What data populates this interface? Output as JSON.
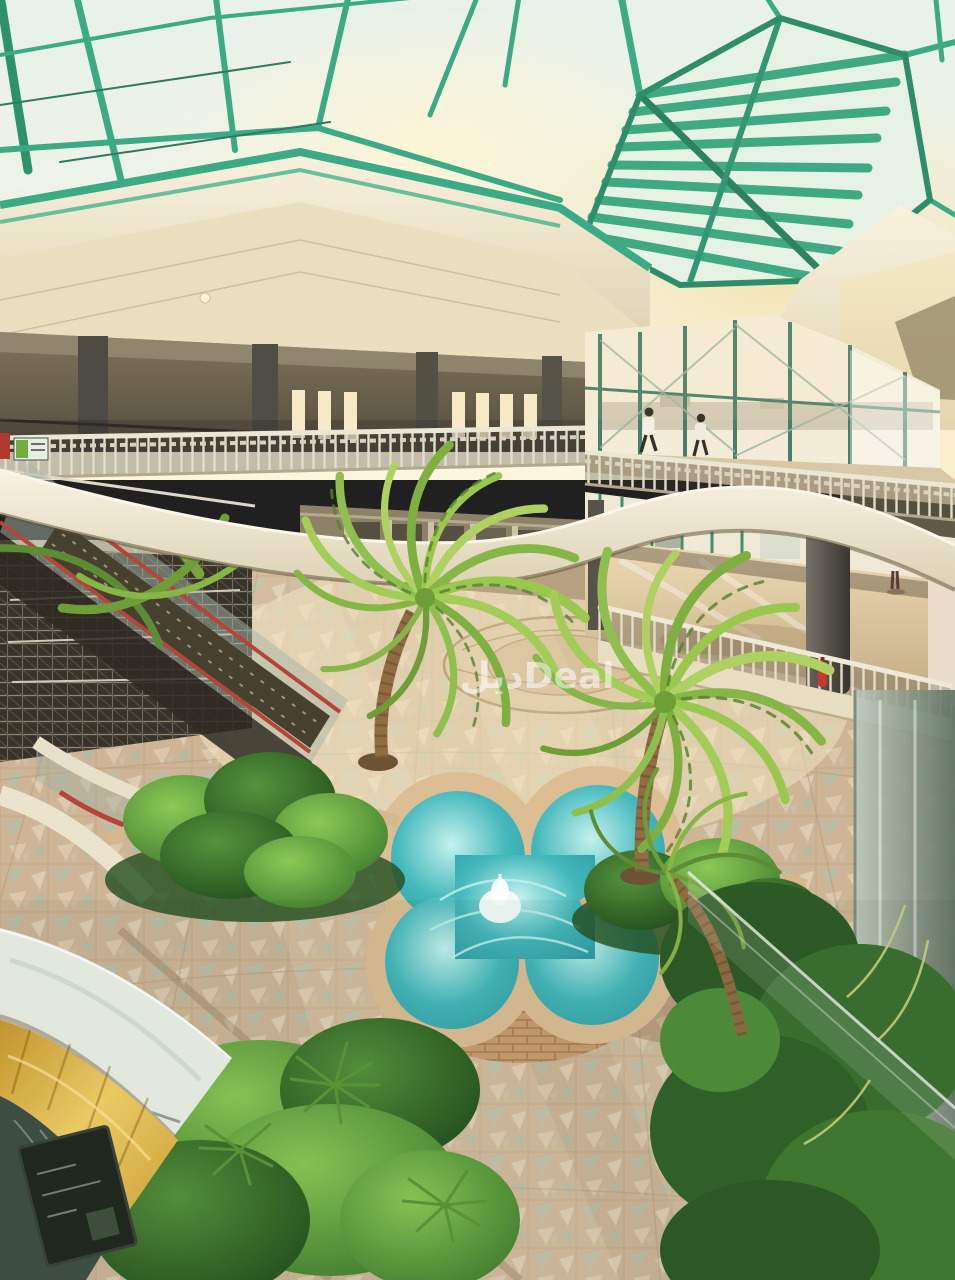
{
  "scene": {
    "description": "Interior atrium of a multi-level shopping mall: green-framed glass skylight roof, upper balconies with ornate railings, escalators, ground courtyard with patterned mosaic tile floor, tropical planters, two palm trees and a quatrefoil fountain with turquoise water",
    "people_visible": 3
  },
  "watermark": {
    "text": "ديلDeal",
    "color": "#ffffff",
    "opacity": 0.55
  },
  "palette": {
    "skylight_frame_green": "#2ba583",
    "glass_sky": "#e9f4f1",
    "sun_glow": "#f8e7ae",
    "fascia_cream": "#f2ecd9",
    "floor_tan": "#cdb596",
    "tile_teal": "#a9c8b6",
    "fountain_water": "#45b8bc",
    "fountain_brick": "#c79e70",
    "foliage_green": "#4e8f3a",
    "palm_light_green": "#a3cc58",
    "kiosk_gold": "#e3b84d",
    "handrail_red": "#b5443a"
  }
}
